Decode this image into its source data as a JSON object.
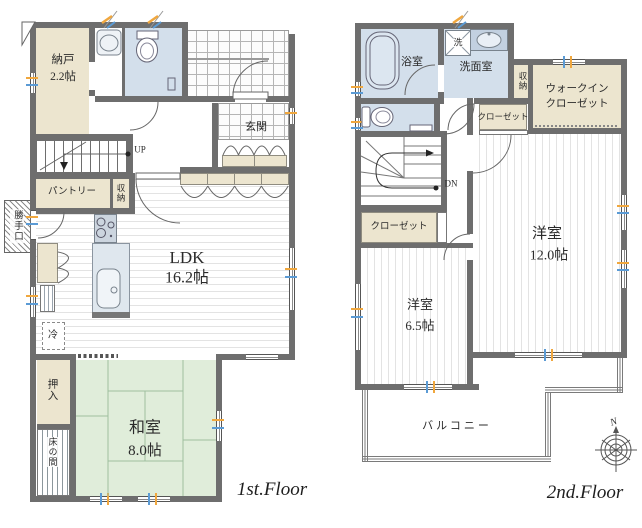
{
  "floor1": {
    "title": "1st.Floor",
    "rooms": {
      "nando": {
        "name": "納戸",
        "size": "2.2帖"
      },
      "genkan": {
        "name": "玄関"
      },
      "pantry": {
        "name": "パントリー"
      },
      "shunou": {
        "name": "収納"
      },
      "katteguchi": {
        "name": "勝手口"
      },
      "ldk": {
        "name": "LDK",
        "size": "16.2帖"
      },
      "reizouko": {
        "name": "冷"
      },
      "oshiire": {
        "name": "押入"
      },
      "washitsu": {
        "name": "和室",
        "size": "8.0帖"
      },
      "tokonoma": {
        "name": "床の間"
      }
    },
    "stairs_label": "UP"
  },
  "floor2": {
    "title": "2nd.Floor",
    "rooms": {
      "yokushitsu": {
        "name": "浴室"
      },
      "sentaku": {
        "name": "洗"
      },
      "senmenshitsu": {
        "name": "洗面室"
      },
      "shunou": {
        "name": "収納"
      },
      "wic": {
        "name_line1": "ウォークイン",
        "name_line2": "クローゼット"
      },
      "closet_main": {
        "name": "クローゼット"
      },
      "closet_sub": {
        "name": "クローゼット"
      },
      "youshitsu12": {
        "name": "洋室",
        "size": "12.0帖"
      },
      "youshitsu65": {
        "name": "洋室",
        "size": "6.5帖"
      },
      "balcony": {
        "name": "バルコニー"
      }
    },
    "stairs_label": "DN",
    "compass_label": "N"
  },
  "colors": {
    "wall": "#6e6e6e",
    "room_beige": "#ece5cf",
    "room_wet_blue": "#d3dfeb",
    "tatami_green": "#e0edda",
    "window_tick_orange": "#f0a73e",
    "window_tick_blue": "#5b9bd5"
  }
}
